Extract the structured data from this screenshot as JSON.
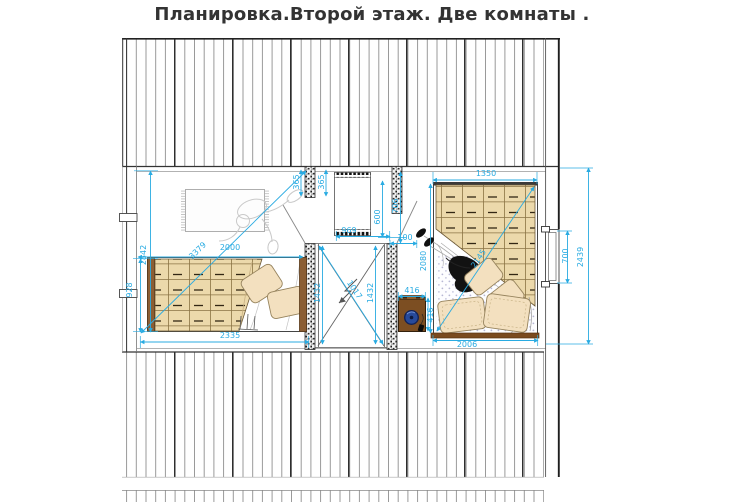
{
  "title": "Планировка.Второй этаж. Две комнаты .",
  "colors": {
    "dimension": "#29abe2",
    "wood": "#7c4e22",
    "blanket": "#ecd9ab",
    "pillow": "#f3e0bf",
    "lamp_blue": "#274a9b"
  },
  "dims": {
    "left_room": {
      "width_top": "2000",
      "diagonal": "3379",
      "height": "2842",
      "bed_width": "928",
      "width_bottom": "2335"
    },
    "stairwell": {
      "post_left": "365",
      "post_right": "365",
      "wardrobe_width": "969",
      "opening_left": "1432",
      "opening_right": "1432",
      "opening_diagonal": "1017",
      "closet_height": "600",
      "wall_height": "706",
      "post_width": "100"
    },
    "right_room": {
      "bed_width": "1350",
      "bed_length": "2080",
      "bed_diagonal": "2145",
      "nightstand_width": "416",
      "nightstand_depth": "416",
      "bed_bottom": "2006",
      "window_width": "700",
      "wall_length": "2439"
    }
  }
}
